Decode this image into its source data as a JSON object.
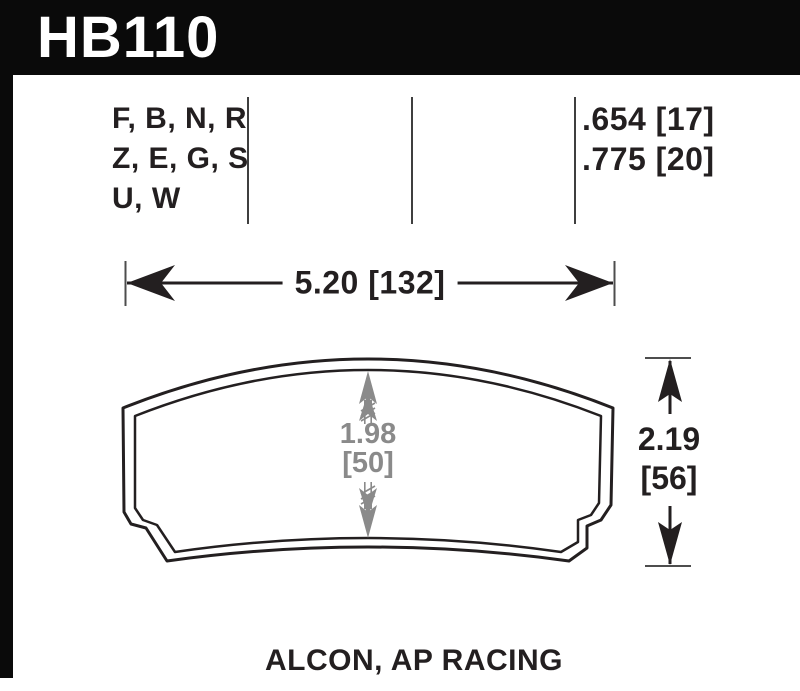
{
  "header": {
    "part_number": "HB110"
  },
  "compound_column": {
    "rows": [
      "F, B, N, R",
      "Z, E, G, S",
      "U, W"
    ]
  },
  "thickness_column": {
    "rows": [
      ".654 [17]",
      ".775 [20]"
    ]
  },
  "dimensions": {
    "overall_width": "5.20 [132]",
    "overall_height_in": "2.19",
    "overall_height_mm": "[56]",
    "pad_height_in": "1.98",
    "pad_height_mm": "[50]"
  },
  "footer": {
    "applications": "ALCON, AP RACING"
  },
  "colors": {
    "header_bg": "#0a0a0a",
    "header_text": "#ffffff",
    "drawing_line": "#231f20",
    "dimension_gray": "#8a8a8a",
    "tick_gray": "#4d4d4d"
  }
}
